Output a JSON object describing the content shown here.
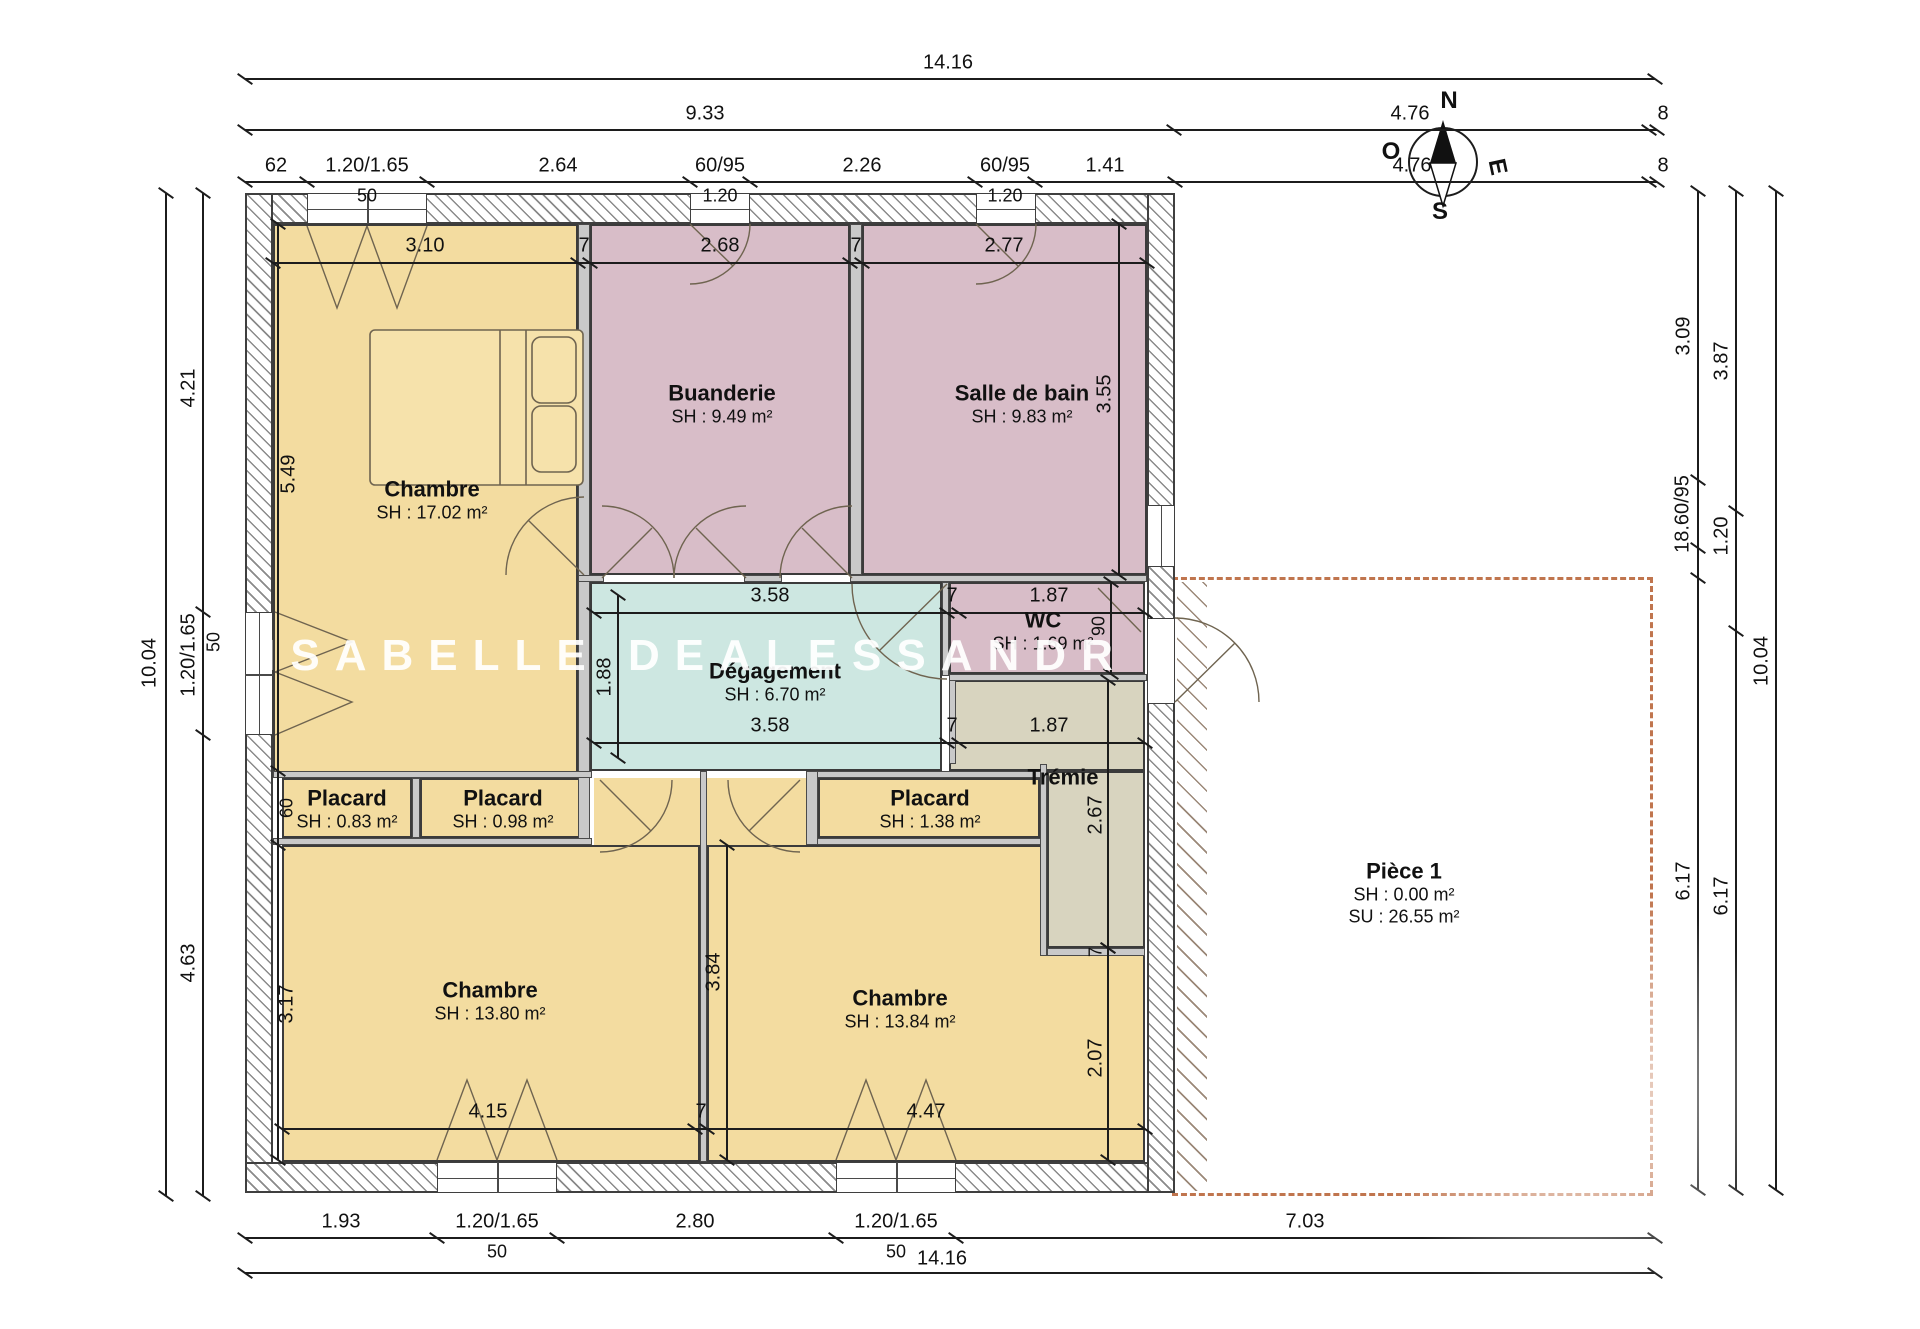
{
  "watermark": "ISABELLE DEALESSANDR",
  "compass": {
    "n": "N",
    "e": "E",
    "s": "S",
    "o": "O"
  },
  "colors": {
    "yellow": "#f3dca0",
    "pink": "#d8bdc8",
    "teal": "#cde7e1",
    "beige": "#d8d4bf",
    "dash_orange": "#c0754e",
    "line": "#1c1c1c"
  },
  "plan": {
    "rooms": [
      {
        "x": 273,
        "y": 224,
        "w": 305,
        "h": 554,
        "c": "yellow"
      },
      {
        "x": 590,
        "y": 224,
        "w": 260,
        "h": 351,
        "c": "pink"
      },
      {
        "x": 862,
        "y": 224,
        "w": 285,
        "h": 351,
        "c": "pink"
      },
      {
        "x": 590,
        "y": 582,
        "w": 352,
        "h": 189,
        "c": "teal"
      },
      {
        "x": 949,
        "y": 582,
        "w": 196,
        "h": 92,
        "c": "pink"
      },
      {
        "x": 282,
        "y": 778,
        "w": 130,
        "h": 60,
        "c": "yellow"
      },
      {
        "x": 420,
        "y": 778,
        "w": 166,
        "h": 60,
        "c": "yellow"
      },
      {
        "x": 818,
        "y": 778,
        "w": 222,
        "h": 60,
        "c": "yellow"
      },
      {
        "x": 282,
        "y": 845,
        "w": 418,
        "h": 317,
        "c": "yellow"
      },
      {
        "x": 594,
        "y": 778,
        "w": 106,
        "h": 67,
        "c": "yellow",
        "nb": true
      },
      {
        "x": 707,
        "y": 845,
        "w": 438,
        "h": 317,
        "c": "yellow"
      },
      {
        "x": 707,
        "y": 778,
        "w": 99,
        "h": 67,
        "c": "yellow",
        "nb": true
      },
      {
        "x": 949,
        "y": 680,
        "w": 196,
        "h": 91,
        "c": "beige"
      },
      {
        "x": 1047,
        "y": 771,
        "w": 98,
        "h": 177,
        "c": "beige"
      }
    ],
    "piece1": {
      "x": 1172,
      "y": 577,
      "w": 481,
      "h": 619
    },
    "piece1_hatch": {
      "x": 1177,
      "y": 582,
      "w": 30,
      "h": 609
    },
    "walls_ext": [
      {
        "x": 245,
        "y": 193,
        "w": 930,
        "h": 31
      },
      {
        "x": 245,
        "y": 193,
        "w": 28,
        "h": 1000
      },
      {
        "x": 245,
        "y": 1162,
        "w": 930,
        "h": 31
      },
      {
        "x": 1147,
        "y": 193,
        "w": 28,
        "h": 1000
      }
    ],
    "walls_int": [
      {
        "x": 578,
        "y": 224,
        "w": 12,
        "h": 621
      },
      {
        "x": 850,
        "y": 224,
        "w": 12,
        "h": 351
      },
      {
        "x": 578,
        "y": 575,
        "w": 26,
        "h": 7
      },
      {
        "x": 744,
        "y": 575,
        "w": 38,
        "h": 7
      },
      {
        "x": 850,
        "y": 575,
        "w": 297,
        "h": 7
      },
      {
        "x": 942,
        "y": 582,
        "w": 7,
        "h": 94
      },
      {
        "x": 949,
        "y": 674,
        "w": 198,
        "h": 7
      },
      {
        "x": 273,
        "y": 771,
        "w": 319,
        "h": 7
      },
      {
        "x": 273,
        "y": 838,
        "w": 319,
        "h": 7
      },
      {
        "x": 412,
        "y": 778,
        "w": 8,
        "h": 60
      },
      {
        "x": 806,
        "y": 771,
        "w": 241,
        "h": 7
      },
      {
        "x": 806,
        "y": 838,
        "w": 241,
        "h": 7
      },
      {
        "x": 806,
        "y": 771,
        "w": 12,
        "h": 74
      },
      {
        "x": 1040,
        "y": 764,
        "w": 7,
        "h": 192
      },
      {
        "x": 1047,
        "y": 948,
        "w": 98,
        "h": 8
      },
      {
        "x": 700,
        "y": 771,
        "w": 7,
        "h": 391
      },
      {
        "x": 949,
        "y": 680,
        "w": 7,
        "h": 84
      }
    ],
    "windows": [
      {
        "x": 307,
        "y": 193,
        "w": 120,
        "h": 31,
        "o": "h",
        "d": true
      },
      {
        "x": 690,
        "y": 193,
        "w": 60,
        "h": 31,
        "o": "h"
      },
      {
        "x": 976,
        "y": 193,
        "w": 60,
        "h": 31,
        "o": "h"
      },
      {
        "x": 437,
        "y": 1162,
        "w": 120,
        "h": 31,
        "o": "h",
        "d": true
      },
      {
        "x": 836,
        "y": 1162,
        "w": 120,
        "h": 31,
        "o": "h",
        "d": true
      },
      {
        "x": 245,
        "y": 612,
        "w": 28,
        "h": 123,
        "o": "v",
        "d": true
      },
      {
        "x": 1147,
        "y": 505,
        "w": 28,
        "h": 62,
        "o": "v"
      },
      {
        "x": 1147,
        "y": 618,
        "w": 28,
        "h": 86,
        "o": "v",
        "plain": true
      }
    ],
    "labels": [
      {
        "x": 432,
        "y": 500,
        "name": "Chambre",
        "area": "SH : 17.02 m²"
      },
      {
        "x": 722,
        "y": 404,
        "name": "Buanderie",
        "area": "SH : 9.49 m²"
      },
      {
        "x": 1022,
        "y": 404,
        "name": "Salle de bain",
        "area": "SH : 9.83 m²"
      },
      {
        "x": 775,
        "y": 682,
        "name": "Dégagement",
        "area": "SH : 6.70 m²"
      },
      {
        "x": 1043,
        "y": 631,
        "name": "WC",
        "area": "SH : 1.69 m²"
      },
      {
        "x": 347,
        "y": 809,
        "name": "Placard",
        "area": "SH : 0.83 m²"
      },
      {
        "x": 503,
        "y": 809,
        "name": "Placard",
        "area": "SH : 0.98 m²"
      },
      {
        "x": 930,
        "y": 809,
        "name": "Placard",
        "area": "SH : 1.38 m²"
      },
      {
        "x": 490,
        "y": 1001,
        "name": "Chambre",
        "area": "SH : 13.80 m²"
      },
      {
        "x": 900,
        "y": 1009,
        "name": "Chambre",
        "area": "SH : 13.84 m²"
      },
      {
        "x": 1063,
        "y": 777,
        "name": "Trémie",
        "area": ""
      },
      {
        "x": 1404,
        "y": 893,
        "name": "Pièce 1",
        "area": "SH : 0.00 m²",
        "area2": "SU : 26.55 m²"
      }
    ],
    "dims": [
      {
        "o": "h",
        "x": 245,
        "y": 78,
        "len": 1410,
        "ticks": [
          0,
          1410
        ],
        "labels": [
          {
            "p": 703,
            "off": -15,
            "t": "14.16"
          }
        ]
      },
      {
        "o": "h",
        "x": 245,
        "y": 129,
        "len": 1412,
        "ticks": [
          0,
          929,
          1404,
          1412
        ],
        "labels": [
          {
            "p": 460,
            "off": -15,
            "t": "9.33"
          },
          {
            "p": 1165,
            "off": -15,
            "t": "4.76"
          },
          {
            "p": 1418,
            "off": -15,
            "t": "8"
          }
        ]
      },
      {
        "o": "h",
        "x": 245,
        "y": 181,
        "len": 1412,
        "ticks": [
          0,
          62,
          182,
          445,
          505,
          730,
          790,
          930,
          1404,
          1412
        ],
        "labels": [
          {
            "p": 31,
            "off": -15,
            "t": "62"
          },
          {
            "p": 122,
            "off": -15,
            "t": "1.20/1.65"
          },
          {
            "p": 313,
            "off": -15,
            "t": "2.64"
          },
          {
            "p": 475,
            "off": -15,
            "t": "60/95"
          },
          {
            "p": 617,
            "off": -15,
            "t": "2.26"
          },
          {
            "p": 760,
            "off": -15,
            "t": "60/95"
          },
          {
            "p": 860,
            "off": -15,
            "t": "1.41"
          },
          {
            "p": 1167,
            "off": -15,
            "t": "4.76"
          },
          {
            "p": 1418,
            "off": -15,
            "t": "8"
          },
          {
            "p": 122,
            "off": 15,
            "t": "50",
            "s": true
          },
          {
            "p": 475,
            "off": 15,
            "t": "1.20",
            "s": true
          },
          {
            "p": 760,
            "off": 15,
            "t": "1.20",
            "s": true
          }
        ]
      },
      {
        "o": "h",
        "x": 273,
        "y": 262,
        "len": 874,
        "ticks": [
          0,
          305,
          317,
          577,
          589,
          874
        ],
        "labels": [
          {
            "p": 152,
            "off": -16,
            "t": "3.10"
          },
          {
            "p": 311,
            "off": -16,
            "t": "7"
          },
          {
            "p": 447,
            "off": -16,
            "t": "2.68"
          },
          {
            "p": 583,
            "off": -16,
            "t": "7"
          },
          {
            "p": 731,
            "off": -16,
            "t": "2.77"
          }
        ]
      },
      {
        "o": "h",
        "x": 594,
        "y": 612,
        "len": 551,
        "ticks": [
          0,
          353,
          365,
          551
        ],
        "labels": [
          {
            "p": 176,
            "off": -16,
            "t": "3.58"
          },
          {
            "p": 358,
            "off": -16,
            "t": "7"
          },
          {
            "p": 455,
            "off": -16,
            "t": "1.87"
          }
        ]
      },
      {
        "o": "h",
        "x": 594,
        "y": 742,
        "len": 551,
        "ticks": [
          0,
          353,
          365,
          551
        ],
        "labels": [
          {
            "p": 176,
            "off": -16,
            "t": "3.58"
          },
          {
            "p": 358,
            "off": -16,
            "t": "7"
          },
          {
            "p": 455,
            "off": -16,
            "t": "1.87"
          }
        ]
      },
      {
        "o": "h",
        "x": 282,
        "y": 1128,
        "len": 863,
        "ticks": [
          0,
          413,
          425,
          863
        ],
        "labels": [
          {
            "p": 206,
            "off": -16,
            "t": "4.15"
          },
          {
            "p": 419,
            "off": -16,
            "t": "7"
          },
          {
            "p": 644,
            "off": -16,
            "t": "4.47"
          }
        ]
      },
      {
        "o": "h",
        "x": 245,
        "y": 1237,
        "len": 1410,
        "ticks": [
          0,
          192,
          312,
          591,
          711,
          1410
        ],
        "labels": [
          {
            "p": 96,
            "off": -15,
            "t": "1.93"
          },
          {
            "p": 252,
            "off": -15,
            "t": "1.20/1.65"
          },
          {
            "p": 450,
            "off": -15,
            "t": "2.80"
          },
          {
            "p": 651,
            "off": -15,
            "t": "1.20/1.65"
          },
          {
            "p": 1060,
            "off": -15,
            "t": "7.03"
          },
          {
            "p": 252,
            "off": 15,
            "t": "50",
            "s": true
          },
          {
            "p": 651,
            "off": 15,
            "t": "50",
            "s": true
          }
        ]
      },
      {
        "o": "h",
        "x": 245,
        "y": 1272,
        "len": 1410,
        "ticks": [
          0,
          1410
        ],
        "labels": [
          {
            "p": 697,
            "off": -13,
            "t": "14.16"
          }
        ]
      },
      {
        "o": "v",
        "x": 165,
        "y": 193,
        "len": 1003,
        "ticks": [
          0,
          1003
        ],
        "labels": [
          {
            "p": 470,
            "off": -15,
            "t": "10.04"
          }
        ]
      },
      {
        "o": "v",
        "x": 202,
        "y": 193,
        "len": 1003,
        "ticks": [
          0,
          419,
          542,
          1003
        ],
        "labels": [
          {
            "p": 195,
            "off": -13,
            "t": "4.21"
          },
          {
            "p": 462,
            "off": -13,
            "t": "1.20/1.65"
          },
          {
            "p": 449,
            "off": 12,
            "t": "50",
            "s": true
          },
          {
            "p": 770,
            "off": -13,
            "t": "4.63"
          }
        ]
      },
      {
        "o": "v",
        "x": 277,
        "y": 224,
        "len": 936,
        "ticks": [
          0,
          547,
          621,
          936
        ],
        "labels": [
          {
            "p": 250,
            "off": 12,
            "t": "5.49"
          },
          {
            "p": 584,
            "off": 10,
            "t": "60",
            "s": true
          },
          {
            "p": 780,
            "off": 10,
            "t": "3.17"
          }
        ]
      },
      {
        "o": "v",
        "x": 1118,
        "y": 224,
        "len": 351,
        "ticks": [
          0,
          351
        ],
        "labels": [
          {
            "p": 170,
            "off": -13,
            "t": "3.55"
          }
        ]
      },
      {
        "o": "v",
        "x": 1110,
        "y": 582,
        "len": 92,
        "ticks": [
          0,
          92
        ],
        "labels": [
          {
            "p": 44,
            "off": -11,
            "t": "90",
            "s": true
          }
        ]
      },
      {
        "o": "v",
        "x": 1107,
        "y": 680,
        "len": 268,
        "ticks": [
          0,
          268
        ],
        "labels": [
          {
            "p": 135,
            "off": -11,
            "t": "2.67"
          },
          {
            "p": 272,
            "off": -11,
            "t": "7",
            "s": true
          }
        ]
      },
      {
        "o": "v",
        "x": 1107,
        "y": 948,
        "len": 212,
        "ticks": [
          0,
          212
        ],
        "labels": [
          {
            "p": 110,
            "off": -11,
            "t": "2.07"
          }
        ]
      },
      {
        "o": "v",
        "x": 726,
        "y": 845,
        "len": 315,
        "ticks": [
          0,
          315
        ],
        "labels": [
          {
            "p": 127,
            "off": -12,
            "t": "3.84"
          }
        ]
      },
      {
        "o": "v",
        "x": 617,
        "y": 595,
        "len": 163,
        "ticks": [
          0,
          163
        ],
        "labels": [
          {
            "p": 82,
            "off": -12,
            "t": "1.88"
          }
        ]
      },
      {
        "o": "v",
        "x": 1697,
        "y": 191,
        "len": 999,
        "ticks": [
          0,
          289,
          357,
          387,
          999
        ],
        "labels": [
          {
            "p": 145,
            "off": -13,
            "t": "3.09"
          },
          {
            "p": 323,
            "off": -14,
            "t": "18.60/95"
          },
          {
            "p": 690,
            "off": -13,
            "t": "6.17"
          }
        ]
      },
      {
        "o": "v",
        "x": 1735,
        "y": 191,
        "len": 999,
        "ticks": [
          0,
          320,
          440,
          999
        ],
        "labels": [
          {
            "p": 170,
            "off": -13,
            "t": "3.87"
          },
          {
            "p": 345,
            "off": -13,
            "t": "1.20"
          },
          {
            "p": 705,
            "off": -13,
            "t": "6.17"
          }
        ]
      },
      {
        "o": "v",
        "x": 1775,
        "y": 191,
        "len": 999,
        "ticks": [
          0,
          999
        ],
        "labels": [
          {
            "p": 470,
            "off": -13,
            "t": "10.04"
          }
        ]
      }
    ]
  }
}
